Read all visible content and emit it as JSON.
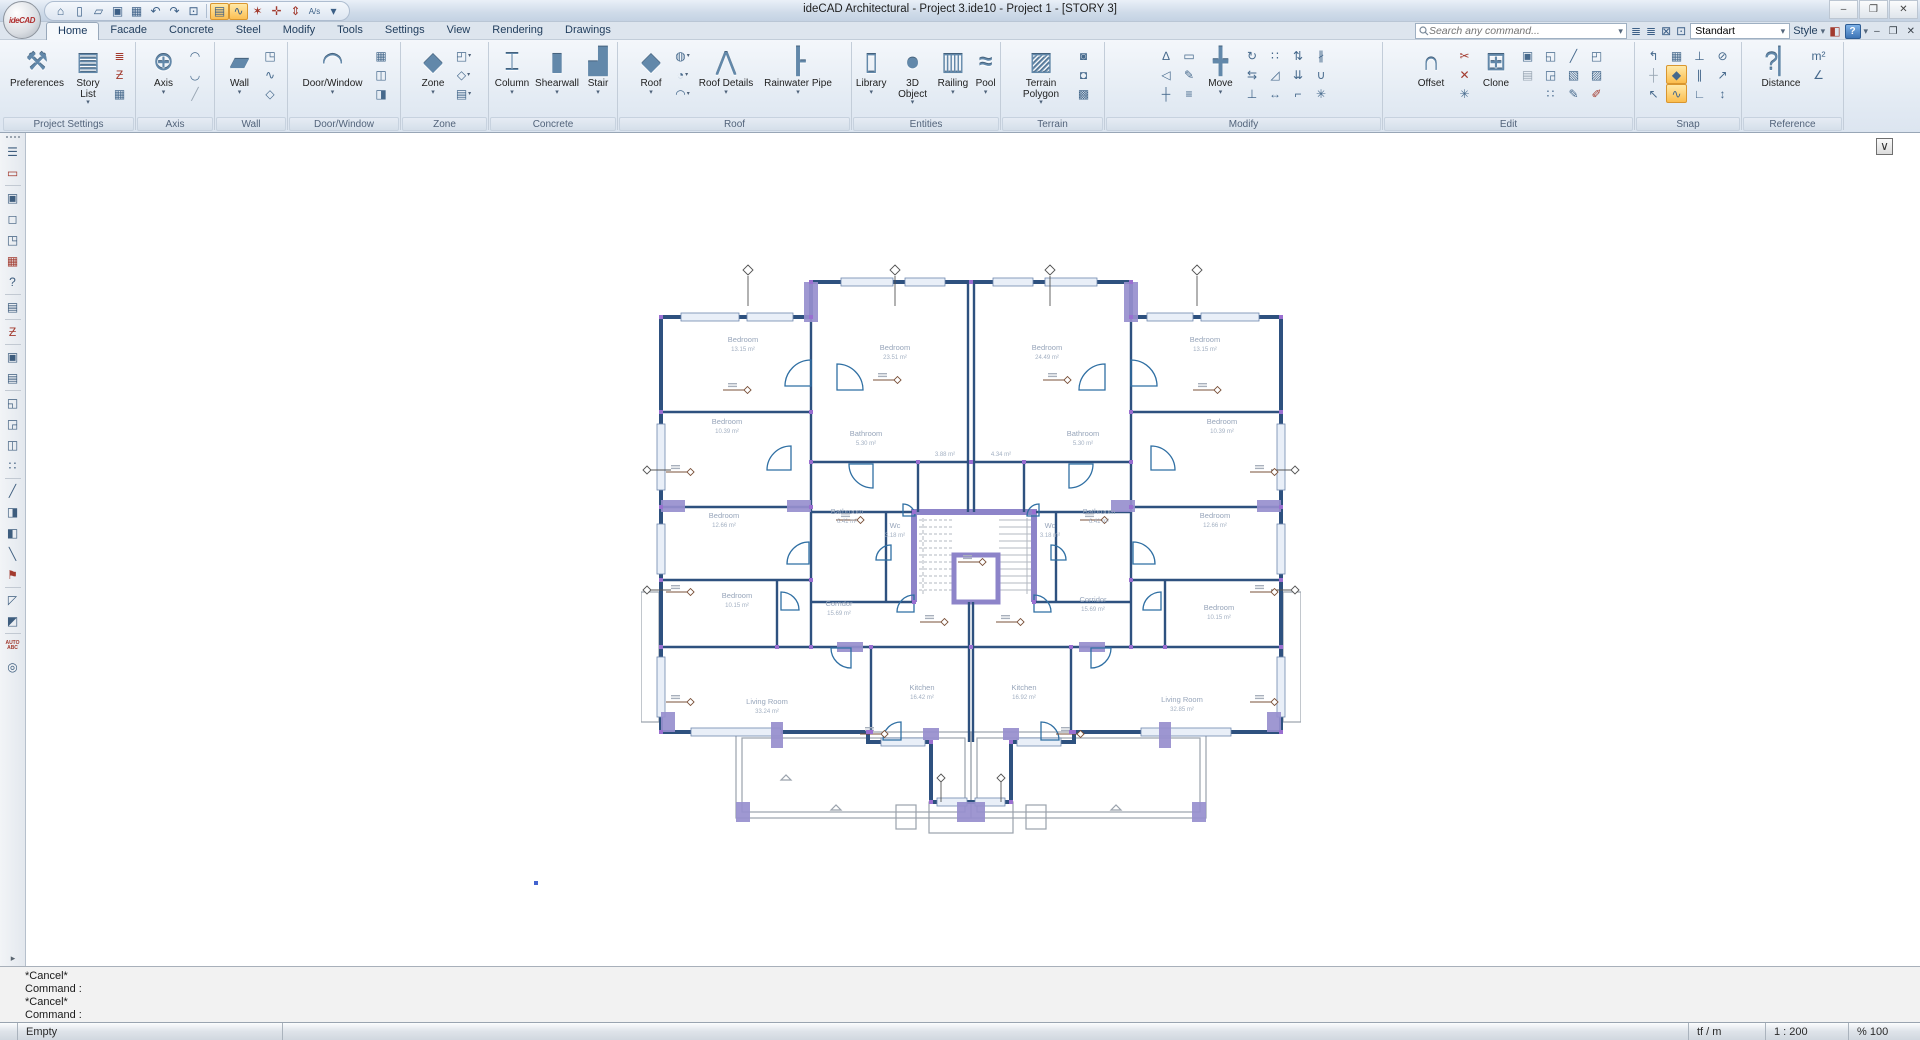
{
  "title_bar": {
    "title": "ideCAD Architectural - Project 3.ide10 - Project 1 - [STORY 3]",
    "logo": "ideCAD",
    "window_buttons": {
      "minimize": "–",
      "maximize": "❐",
      "close": "✕"
    }
  },
  "quick_access": [
    {
      "name": "home-icon",
      "g": "⌂"
    },
    {
      "name": "new-file-icon",
      "g": "▯"
    },
    {
      "name": "open-file-icon",
      "g": "▱"
    },
    {
      "name": "save-icon",
      "g": "▣"
    },
    {
      "name": "save-all-icon",
      "g": "▦"
    },
    {
      "name": "undo-icon",
      "g": "↶"
    },
    {
      "name": "redo-icon",
      "g": "↷"
    },
    {
      "name": "undo-view-icon",
      "g": "⊡"
    },
    {
      "name": "sep"
    },
    {
      "name": "story-display-icon",
      "g": "▤",
      "hl": true
    },
    {
      "name": "polyline-lock-icon",
      "g": "∿",
      "hl": true
    },
    {
      "name": "snap-fly-icon",
      "g": "✶",
      "red": true
    },
    {
      "name": "snap-perp-icon",
      "g": "✛",
      "red": true
    },
    {
      "name": "dimension-icon",
      "g": "⇕",
      "red": true
    },
    {
      "name": "scale-text-icon",
      "g": "A/s",
      "txt": true
    },
    {
      "name": "qat-more-icon",
      "g": "▾"
    }
  ],
  "ribbon": {
    "tabs": [
      "Home",
      "Facade",
      "Concrete",
      "Steel",
      "Modify",
      "Tools",
      "Settings",
      "View",
      "Rendering",
      "Drawings"
    ],
    "active_tab": "Home",
    "search": {
      "placeholder": "Search any command..."
    },
    "standart_combo": "Standart",
    "style_label": "Style",
    "groups": [
      {
        "label": "Project Settings",
        "w": 133,
        "items": [
          {
            "t": "b",
            "label": "Preferences",
            "icon": "preferences-icon",
            "w": 62
          },
          {
            "t": "b",
            "label": "Story List",
            "icon": "story-list-icon",
            "arr": 1,
            "w": 40
          },
          {
            "t": "c",
            "ic": [
              {
                "i": "story-stack-icon",
                "red": 1
              },
              {
                "i": "story-section-icon",
                "red": 1
              },
              {
                "i": "report-icon"
              }
            ]
          }
        ]
      },
      {
        "label": "Axis",
        "w": 78,
        "items": [
          {
            "t": "b",
            "label": "Axis",
            "icon": "axis-icon",
            "arr": 1,
            "w": 40
          },
          {
            "t": "c",
            "ic": [
              {
                "i": "arc-axis-icon"
              },
              {
                "i": "arc-axis2-icon"
              },
              {
                "i": "diagonal-axis-icon",
                "dim": 1
              }
            ]
          }
        ]
      },
      {
        "label": "Wall",
        "w": 72,
        "items": [
          {
            "t": "b",
            "label": "Wall",
            "icon": "wall-icon",
            "arr": 1,
            "w": 38
          },
          {
            "t": "c",
            "ic": [
              {
                "i": "wall-corner-icon"
              },
              {
                "i": "wall-poly-icon"
              },
              {
                "i": "wall-gem-icon"
              }
            ]
          }
        ]
      },
      {
        "label": "Door/Window",
        "w": 112,
        "items": [
          {
            "t": "b",
            "label": "Door/Window",
            "icon": "door-window-icon",
            "arr": 1,
            "w": 74
          },
          {
            "t": "c",
            "ic": [
              {
                "i": "window-grid-icon"
              },
              {
                "i": "window-pane-icon"
              },
              {
                "i": "window-3d-icon"
              }
            ]
          }
        ]
      },
      {
        "label": "Zone",
        "w": 87,
        "items": [
          {
            "t": "b",
            "label": "Zone",
            "icon": "zone-icon",
            "arr": 1,
            "w": 38
          },
          {
            "t": "c",
            "ic": [
              {
                "i": "zone-l-icon",
                "arr": 1
              },
              {
                "i": "zone-gem-icon",
                "arr": 1
              },
              {
                "i": "zone-stack-icon",
                "arr": 1
              }
            ]
          }
        ]
      },
      {
        "label": "Concrete",
        "w": 128,
        "items": [
          {
            "t": "b",
            "label": "Column",
            "icon": "column-icon",
            "arr": 1,
            "w": 42
          },
          {
            "t": "b",
            "label": "Shearwall",
            "icon": "shearwall-icon",
            "arr": 1,
            "w": 48
          },
          {
            "t": "b",
            "label": "Stair",
            "icon": "stair-icon",
            "arr": 1,
            "w": 34
          }
        ]
      },
      {
        "label": "Roof",
        "w": 233,
        "items": [
          {
            "t": "b",
            "label": "Roof",
            "icon": "roof-icon",
            "arr": 1,
            "w": 40
          },
          {
            "t": "c",
            "ic": [
              {
                "i": "dome-icon",
                "arr": 1
              },
              {
                "i": "roof-window-icon",
                "arr": 1
              },
              {
                "i": "awning-icon",
                "arr": 1
              }
            ]
          },
          {
            "t": "b",
            "label": "Roof Details",
            "icon": "roof-details-icon",
            "arr": 1,
            "w": 64
          },
          {
            "t": "b",
            "label": "Rainwater Pipe",
            "icon": "rainwater-pipe-icon",
            "arr": 1,
            "w": 80
          }
        ]
      },
      {
        "label": "Entities",
        "w": 148,
        "items": [
          {
            "t": "b",
            "label": "Library",
            "icon": "library-icon",
            "arr": 1,
            "w": 40
          },
          {
            "t": "b",
            "label": "3D Object",
            "icon": "object-3d-icon",
            "arr": 1,
            "w": 46
          },
          {
            "t": "b",
            "label": "Railing",
            "icon": "railing-icon",
            "arr": 1,
            "w": 38
          },
          {
            "t": "b",
            "label": "Pool",
            "icon": "pool-icon",
            "arr": 1,
            "w": 30
          }
        ]
      },
      {
        "label": "Terrain",
        "w": 103,
        "items": [
          {
            "t": "b",
            "label": "Terrain Polygon",
            "icon": "terrain-polygon-icon",
            "arr": 1,
            "w": 62
          },
          {
            "t": "c",
            "ic": [
              {
                "i": "terrain-fill-icon"
              },
              {
                "i": "terrain-cut-icon"
              },
              {
                "i": "terrain-green-icon"
              }
            ]
          }
        ]
      },
      {
        "label": "Modify",
        "w": 277,
        "items": [
          {
            "t": "c",
            "ic": [
              {
                "i": "snap-angle-icon"
              },
              {
                "i": "angle-ref-icon"
              },
              {
                "i": "axis-move-icon"
              }
            ]
          },
          {
            "t": "c",
            "ic": [
              {
                "i": "measure-edit-icon"
              },
              {
                "i": "picker-icon"
              },
              {
                "i": "note-edit-icon"
              }
            ]
          },
          {
            "t": "b",
            "label": "Move",
            "icon": "move-icon",
            "arr": 1,
            "w": 40
          },
          {
            "t": "c",
            "ic": [
              {
                "i": "rotate-icon"
              },
              {
                "i": "mirror-icon"
              },
              {
                "i": "align-bottom-icon"
              }
            ]
          },
          {
            "t": "c",
            "ic": [
              {
                "i": "array-icon"
              },
              {
                "i": "scale-icon"
              },
              {
                "i": "stretch-icon"
              }
            ]
          },
          {
            "t": "c",
            "ic": [
              {
                "i": "raise-icon"
              },
              {
                "i": "lower-icon"
              },
              {
                "i": "project-icon"
              }
            ]
          },
          {
            "t": "c",
            "ic": [
              {
                "i": "divide-icon"
              },
              {
                "i": "merge-icon"
              },
              {
                "i": "explode-icon"
              }
            ]
          }
        ]
      },
      {
        "label": "Edit",
        "w": 251,
        "items": [
          {
            "t": "b",
            "label": "Offset",
            "icon": "offset-icon",
            "w": 44
          },
          {
            "t": "c",
            "ic": [
              {
                "i": "break-icon",
                "red": 1
              },
              {
                "i": "intersect-icon",
                "red": 1
              },
              {
                "i": "extend-point-icon"
              }
            ]
          },
          {
            "t": "b",
            "label": "Clone",
            "icon": "clone-icon",
            "w": 40
          },
          {
            "t": "c",
            "ic": [
              {
                "i": "copy-icon"
              },
              {
                "i": "paste-icon",
                "dim": 1
              }
            ]
          },
          {
            "t": "c",
            "ic": [
              {
                "i": "group-icon"
              },
              {
                "i": "ungroup-icon"
              },
              {
                "i": "array2-icon"
              }
            ]
          },
          {
            "t": "c",
            "ic": [
              {
                "i": "trim-icon"
              },
              {
                "i": "hatch-icon"
              },
              {
                "i": "edit-node-icon"
              }
            ]
          },
          {
            "t": "c",
            "ic": [
              {
                "i": "region-icon"
              },
              {
                "i": "pattern-icon"
              },
              {
                "i": "erase-icon",
                "red": 1
              }
            ]
          }
        ]
      },
      {
        "label": "Snap",
        "w": 106,
        "items": [
          {
            "t": "c",
            "ic": [
              {
                "i": "snap-turn-icon"
              },
              {
                "i": "snap-axis-icon",
                "dim": 1
              },
              {
                "i": "snap-cursor-icon"
              }
            ]
          },
          {
            "t": "c",
            "ic": [
              {
                "i": "snap-grid-icon"
              },
              {
                "i": "snap-node-icon",
                "hl": 1
              },
              {
                "i": "snap-poly-icon",
                "hl": 1
              }
            ]
          },
          {
            "t": "c",
            "ic": [
              {
                "i": "snap-perp2-icon"
              },
              {
                "i": "snap-parallel-icon"
              },
              {
                "i": "snap-corner-icon"
              }
            ]
          },
          {
            "t": "c",
            "ic": [
              {
                "i": "snap-circle-icon"
              },
              {
                "i": "snap-point-icon"
              },
              {
                "i": "snap-vertical-icon"
              }
            ]
          }
        ]
      },
      {
        "label": "Reference",
        "w": 101,
        "items": [
          {
            "t": "b",
            "label": "Distance",
            "icon": "distance-icon",
            "w": 52
          },
          {
            "t": "c",
            "ic": [
              {
                "i": "area-m2-icon"
              },
              {
                "i": "angle-icon"
              }
            ]
          }
        ]
      }
    ]
  },
  "left_toolbar": [
    {
      "name": "properties-panel-icon",
      "g": "☰"
    },
    {
      "name": "select-entity-icon",
      "g": "▭",
      "red": 1,
      "sep": 1
    },
    {
      "name": "select-add-icon",
      "g": "▣"
    },
    {
      "name": "node-edit-icon",
      "g": "◻"
    },
    {
      "name": "node-clone-icon",
      "g": "◳"
    },
    {
      "name": "table-select-icon",
      "g": "▦",
      "red": 1
    },
    {
      "name": "query-info-icon",
      "g": "?",
      "sep": 1
    },
    {
      "name": "sheet-icon",
      "g": "▤",
      "sep": 1
    },
    {
      "name": "story-section-icon",
      "g": "Ƶ",
      "red": 1,
      "sep": 1
    },
    {
      "name": "copy-icon",
      "g": "▣"
    },
    {
      "name": "paste-icon",
      "g": "▤",
      "sep": 1
    },
    {
      "name": "move-object-icon",
      "g": "◱"
    },
    {
      "name": "clone-object-icon",
      "g": "◲"
    },
    {
      "name": "mirror-window-icon",
      "g": "◫"
    },
    {
      "name": "array-dots-icon",
      "g": "∷",
      "sep": 1
    },
    {
      "name": "trim-slash-icon",
      "g": "╱"
    },
    {
      "name": "door-elevation-icon",
      "g": "◨"
    },
    {
      "name": "slab-icon",
      "g": "◧"
    },
    {
      "name": "line-diagonal-icon",
      "g": "╲"
    },
    {
      "name": "flag-icon",
      "g": "⚑",
      "red": 1,
      "sep": 1
    },
    {
      "name": "corner-select-icon",
      "g": "◸"
    },
    {
      "name": "paint-icon",
      "g": "◩",
      "sep": 1
    },
    {
      "name": "auto-label-icon",
      "g": "AUTO ABC",
      "tiny": 1
    },
    {
      "name": "find-icon",
      "g": "◎"
    }
  ],
  "canvas": {
    "confirm_button": "∨"
  },
  "plan": {
    "rooms": [
      {
        "name": "Bedroom",
        "area": "13.15 m²",
        "x": 102,
        "y": 80
      },
      {
        "name": "Bedroom",
        "area": "23.51 m²",
        "x": 254,
        "y": 88
      },
      {
        "name": "Bedroom",
        "area": "24.49 m²",
        "x": 406,
        "y": 88
      },
      {
        "name": "Bedroom",
        "area": "13.15 m²",
        "x": 564,
        "y": 80
      },
      {
        "name": "Bedroom",
        "area": "10.39 m²",
        "x": 86,
        "y": 162
      },
      {
        "name": "Bathroom",
        "area": "5.30 m²",
        "x": 225,
        "y": 174
      },
      {
        "name": "",
        "area": "3.88 m²",
        "x": 304,
        "y": 194
      },
      {
        "name": "",
        "area": "4.34 m²",
        "x": 360,
        "y": 194
      },
      {
        "name": "Bathroom",
        "area": "5.30 m²",
        "x": 442,
        "y": 174
      },
      {
        "name": "Bedroom",
        "area": "10.39 m²",
        "x": 581,
        "y": 162
      },
      {
        "name": "Bedroom",
        "area": "12.66 m²",
        "x": 83,
        "y": 256
      },
      {
        "name": "Bathroom",
        "area": "6.41 m²",
        "x": 206,
        "y": 252
      },
      {
        "name": "Wc",
        "area": "3.18 m²",
        "x": 254,
        "y": 266
      },
      {
        "name": "Wc",
        "area": "3.18 m²",
        "x": 409,
        "y": 266
      },
      {
        "name": "Bathroom",
        "area": "6.41 m²",
        "x": 458,
        "y": 252
      },
      {
        "name": "Bedroom",
        "area": "12.66 m²",
        "x": 574,
        "y": 256
      },
      {
        "name": "Bedroom",
        "area": "10.15 m²",
        "x": 96,
        "y": 336
      },
      {
        "name": "Corridor",
        "area": "15.69 m²",
        "x": 198,
        "y": 344
      },
      {
        "name": "Corridor",
        "area": "15.69 m²",
        "x": 452,
        "y": 340
      },
      {
        "name": "Bedroom",
        "area": "10.15 m²",
        "x": 578,
        "y": 348
      },
      {
        "name": "Living Room",
        "area": "33.24 m²",
        "x": 126,
        "y": 442
      },
      {
        "name": "Kitchen",
        "area": "16.42 m²",
        "x": 281,
        "y": 428
      },
      {
        "name": "Kitchen",
        "area": "16.92 m²",
        "x": 383,
        "y": 428
      },
      {
        "name": "Living Room",
        "area": "32.85 m²",
        "x": 541,
        "y": 440
      }
    ]
  },
  "command_panel": {
    "lines": [
      "*Cancel*",
      "Command :",
      "*Cancel*",
      "Command :"
    ]
  },
  "status_bar": {
    "left": "Empty",
    "unit": "tf / m",
    "scale": "1 : 200",
    "zoom": "% 100"
  }
}
